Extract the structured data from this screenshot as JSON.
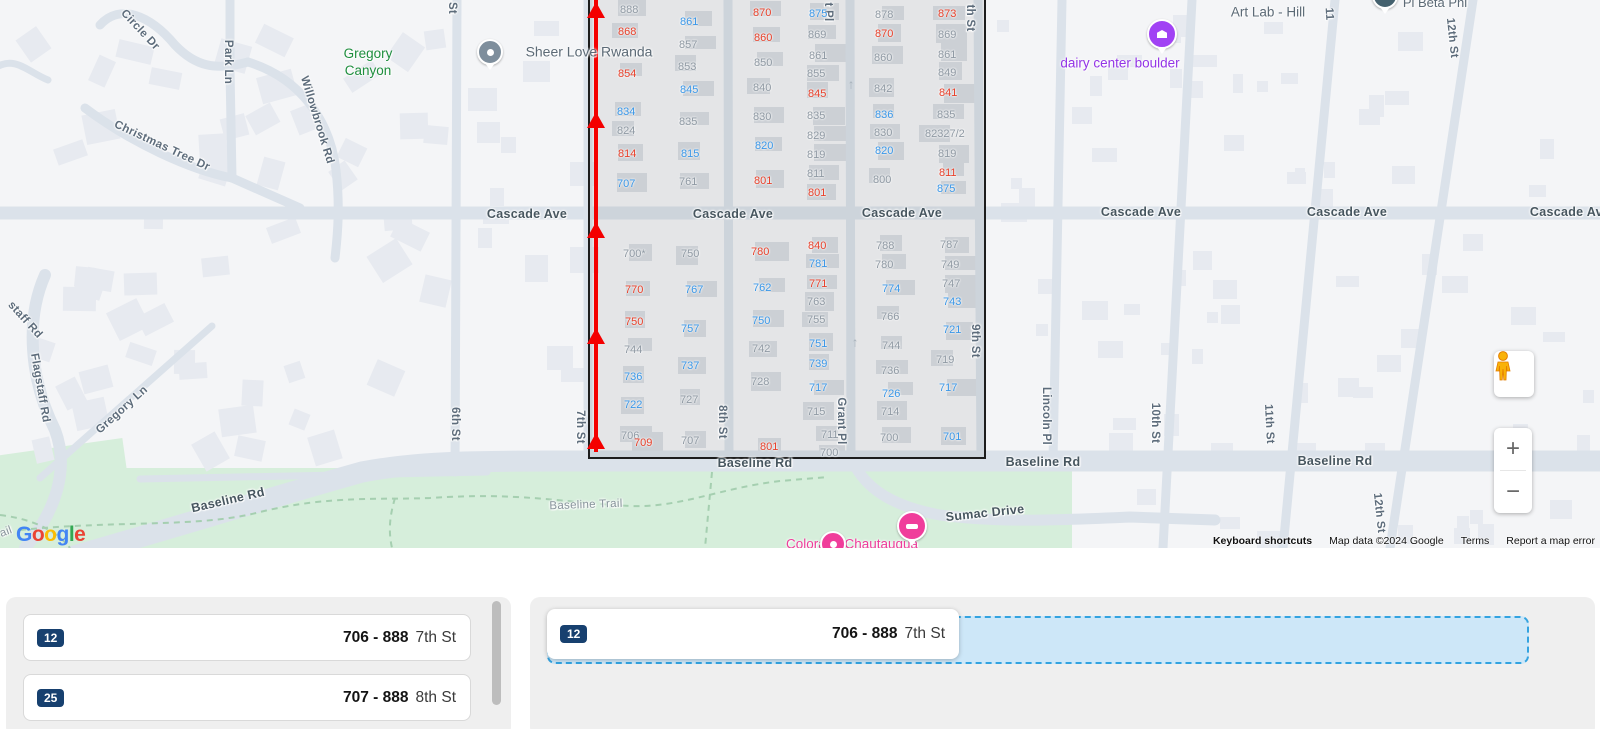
{
  "map": {
    "attribution": {
      "keyboard_shortcuts": "Keyboard shortcuts",
      "map_data": "Map data ©2024 Google",
      "terms": "Terms",
      "report_error": "Report a map error"
    },
    "logo_letters": [
      [
        "G",
        "#4285F4"
      ],
      [
        "o",
        "#EA4335"
      ],
      [
        "o",
        "#FBBC05"
      ],
      [
        "g",
        "#4285F4"
      ],
      [
        "l",
        "#34A853"
      ],
      [
        "e",
        "#EA4335"
      ]
    ],
    "controls": {
      "zoom_in": "+",
      "zoom_out": "−"
    },
    "street_labels": [
      [
        "Circle Dr",
        140,
        30,
        47,
        0
      ],
      [
        "Park Ln",
        228,
        62,
        90,
        0
      ],
      [
        "Willowbrook Rd",
        317,
        120,
        73,
        0
      ],
      [
        "Christmas Tree Dr",
        162,
        146,
        25,
        0
      ],
      [
        "staff Rd",
        25,
        320,
        48,
        0
      ],
      [
        "Flagstaff Rd",
        40,
        388,
        80,
        0
      ],
      [
        "Gregory Ln",
        122,
        410,
        -42,
        0
      ],
      [
        "Baseline Rd",
        228,
        500,
        -13,
        1
      ],
      [
        "Baseline Trail",
        586,
        505,
        -2,
        2
      ],
      [
        "ail",
        6,
        532,
        -20,
        2
      ],
      [
        "Sumac Drive",
        985,
        513,
        -6,
        1
      ],
      [
        "6th St",
        455,
        424,
        90,
        0
      ],
      [
        "St",
        452,
        8,
        90,
        0
      ],
      [
        "7th St",
        580,
        427,
        90,
        0
      ],
      [
        "8th St",
        722,
        422,
        90,
        0
      ],
      [
        "Grant Pl",
        841,
        421,
        90,
        0
      ],
      [
        "t Pl",
        828,
        12,
        90,
        0
      ],
      [
        "9th St",
        975,
        341,
        90,
        0
      ],
      [
        "th St",
        970,
        18,
        90,
        0
      ],
      [
        "Lincoln Pl",
        1046,
        416,
        90,
        0
      ],
      [
        "10th St",
        1155,
        423,
        90,
        0
      ],
      [
        "11th St",
        1269,
        424,
        87,
        0
      ],
      [
        "11",
        1329,
        14,
        87,
        0
      ],
      [
        "12th St",
        1452,
        38,
        84,
        0
      ],
      [
        "12th St",
        1379,
        513,
        84,
        0
      ],
      [
        "Cascade Ave",
        527,
        214,
        0,
        1
      ],
      [
        "Cascade Ave",
        733,
        214,
        0,
        1
      ],
      [
        "Cascade Ave",
        902,
        213,
        0,
        1
      ],
      [
        "Cascade Ave",
        1141,
        212,
        0,
        1
      ],
      [
        "Cascade Ave",
        1347,
        212,
        0,
        1
      ],
      [
        "Cascade Ave",
        1570,
        212,
        0,
        1
      ],
      [
        "Baseline Rd",
        755,
        463,
        0,
        1
      ],
      [
        "Baseline Rd",
        1043,
        462,
        0,
        1
      ],
      [
        "Baseline Rd",
        1335,
        461,
        0,
        1
      ]
    ],
    "place_labels": [
      [
        "Gregory\nCanyon",
        368,
        63,
        "#1e8e3e",
        13.5
      ],
      [
        "Sheer Love Rwanda",
        589,
        52,
        "#5c6a76",
        14
      ],
      [
        "Art Lab - Hill",
        1268,
        13,
        "#5c6a76",
        13.5
      ],
      [
        "dairy center boulder",
        1120,
        64,
        "#9334e6",
        13.5
      ],
      [
        "Pi Beta Phi",
        1435,
        3,
        "#5c6a76",
        13
      ],
      [
        "Colorado Chautauqua",
        852,
        545,
        "#ee3d9b",
        13.5
      ]
    ],
    "pins": [
      [
        "poi-dot-pin",
        490,
        52,
        "#7e8e9c"
      ],
      [
        "museum-pin",
        1162,
        34,
        "#a142f4"
      ],
      [
        "bed-pin",
        912,
        526,
        "#f03d9b"
      ],
      [
        "poi-dot-pin",
        1385,
        -4,
        "#44616e"
      ],
      [
        "poi-dot-pin",
        833,
        544,
        "#f03d9b"
      ]
    ],
    "house_numbers": [
      [
        "888",
        620,
        4,
        "g"
      ],
      [
        "868",
        618,
        26,
        "r"
      ],
      [
        "854",
        618,
        68,
        "r"
      ],
      [
        "834",
        617,
        106,
        "b"
      ],
      [
        "824",
        617,
        125,
        "g"
      ],
      [
        "814",
        618,
        148,
        "r"
      ],
      [
        "707",
        617,
        178,
        "b"
      ],
      [
        "861",
        680,
        16,
        "b"
      ],
      [
        "857",
        679,
        39,
        "g"
      ],
      [
        "853",
        678,
        61,
        "g"
      ],
      [
        "845",
        680,
        84,
        "b"
      ],
      [
        "835",
        679,
        116,
        "g"
      ],
      [
        "815",
        681,
        148,
        "b"
      ],
      [
        "761",
        679,
        176,
        "g"
      ],
      [
        "870",
        753,
        7,
        "r"
      ],
      [
        "860",
        754,
        32,
        "r"
      ],
      [
        "850",
        754,
        57,
        "g"
      ],
      [
        "840",
        753,
        82,
        "g"
      ],
      [
        "830",
        753,
        111,
        "g"
      ],
      [
        "820",
        755,
        140,
        "b"
      ],
      [
        "801",
        754,
        175,
        "r"
      ],
      [
        "875",
        809,
        8,
        "b"
      ],
      [
        "869",
        808,
        29,
        "g"
      ],
      [
        "861",
        809,
        50,
        "g"
      ],
      [
        "855",
        807,
        68,
        "g"
      ],
      [
        "845",
        808,
        88,
        "r"
      ],
      [
        "835",
        807,
        110,
        "g"
      ],
      [
        "829",
        807,
        130,
        "g"
      ],
      [
        "819",
        807,
        149,
        "g"
      ],
      [
        "811",
        807,
        168,
        "g"
      ],
      [
        "801",
        808,
        187,
        "r"
      ],
      [
        "878",
        875,
        9,
        "g"
      ],
      [
        "870",
        875,
        28,
        "r"
      ],
      [
        "860",
        874,
        52,
        "g"
      ],
      [
        "842",
        874,
        83,
        "g"
      ],
      [
        "836",
        875,
        109,
        "b"
      ],
      [
        "830",
        874,
        127,
        "g"
      ],
      [
        "820",
        875,
        145,
        "b"
      ],
      [
        "800",
        873,
        174,
        "g"
      ],
      [
        "873",
        938,
        8,
        "r"
      ],
      [
        "869",
        938,
        29,
        "g"
      ],
      [
        "861",
        938,
        49,
        "g"
      ],
      [
        "849",
        938,
        67,
        "g"
      ],
      [
        "841",
        939,
        87,
        "r"
      ],
      [
        "835",
        937,
        109,
        "g"
      ],
      [
        "82327/2",
        925,
        128,
        "g"
      ],
      [
        "819",
        938,
        148,
        "g"
      ],
      [
        "811",
        939,
        167,
        "r"
      ],
      [
        "875",
        937,
        183,
        "b"
      ],
      [
        "700*",
        623,
        248,
        "g"
      ],
      [
        "770",
        625,
        284,
        "r"
      ],
      [
        "750",
        625,
        316,
        "r"
      ],
      [
        "744",
        624,
        344,
        "g"
      ],
      [
        "736",
        624,
        371,
        "b"
      ],
      [
        "722",
        624,
        399,
        "b"
      ],
      [
        "706",
        621,
        430,
        "g"
      ],
      [
        "709",
        634,
        437,
        "r"
      ],
      [
        "750",
        681,
        248,
        "g"
      ],
      [
        "767",
        685,
        284,
        "b"
      ],
      [
        "757",
        681,
        323,
        "b"
      ],
      [
        "737",
        681,
        360,
        "b"
      ],
      [
        "727",
        680,
        394,
        "g"
      ],
      [
        "707",
        681,
        435,
        "g"
      ],
      [
        "780",
        751,
        246,
        "r"
      ],
      [
        "762",
        753,
        282,
        "b"
      ],
      [
        "750",
        752,
        315,
        "b"
      ],
      [
        "742",
        752,
        343,
        "g"
      ],
      [
        "728",
        751,
        376,
        "g"
      ],
      [
        "801",
        760,
        441,
        "r"
      ],
      [
        "840",
        808,
        240,
        "r"
      ],
      [
        "781",
        809,
        258,
        "b"
      ],
      [
        "771",
        809,
        278,
        "r"
      ],
      [
        "763",
        807,
        296,
        "g"
      ],
      [
        "755",
        807,
        314,
        "g"
      ],
      [
        "751",
        809,
        338,
        "b"
      ],
      [
        "739",
        809,
        358,
        "b"
      ],
      [
        "717",
        809,
        382,
        "b"
      ],
      [
        "715",
        807,
        406,
        "g"
      ],
      [
        "711",
        821,
        429,
        "g"
      ],
      [
        "700",
        820,
        447,
        "g"
      ],
      [
        "788",
        876,
        240,
        "g"
      ],
      [
        "780",
        875,
        259,
        "g"
      ],
      [
        "774",
        882,
        283,
        "b"
      ],
      [
        "766",
        881,
        311,
        "g"
      ],
      [
        "744",
        882,
        340,
        "g"
      ],
      [
        "736",
        881,
        365,
        "g"
      ],
      [
        "726",
        882,
        388,
        "b"
      ],
      [
        "714",
        881,
        406,
        "g"
      ],
      [
        "700",
        880,
        432,
        "g"
      ],
      [
        "787",
        940,
        239,
        "g"
      ],
      [
        "749",
        941,
        259,
        "g"
      ],
      [
        "747",
        942,
        278,
        "g"
      ],
      [
        "743",
        943,
        296,
        "b"
      ],
      [
        "721",
        943,
        324,
        "b"
      ],
      [
        "719",
        936,
        354,
        "g"
      ],
      [
        "717",
        939,
        382,
        "b"
      ],
      [
        "701",
        943,
        431,
        "b"
      ]
    ],
    "oneway_arrows": [
      [
        851,
        84
      ],
      [
        855,
        342
      ]
    ],
    "oneway_glyph": "↑",
    "selection": {
      "x": 588,
      "y": 0,
      "w": 394,
      "h": 457
    },
    "route": {
      "x": 594,
      "w": 4,
      "h": 452,
      "arrow_ys": [
        2,
        112,
        222,
        328,
        433
      ]
    }
  },
  "panels": {
    "left": {
      "items": [
        {
          "badge": "12",
          "range": "706 - 888",
          "street": "7th St"
        },
        {
          "badge": "25",
          "range": "707 - 888",
          "street": "8th St"
        }
      ]
    },
    "right": {
      "card": {
        "badge": "12",
        "range": "706 - 888",
        "street": "7th St"
      }
    }
  }
}
